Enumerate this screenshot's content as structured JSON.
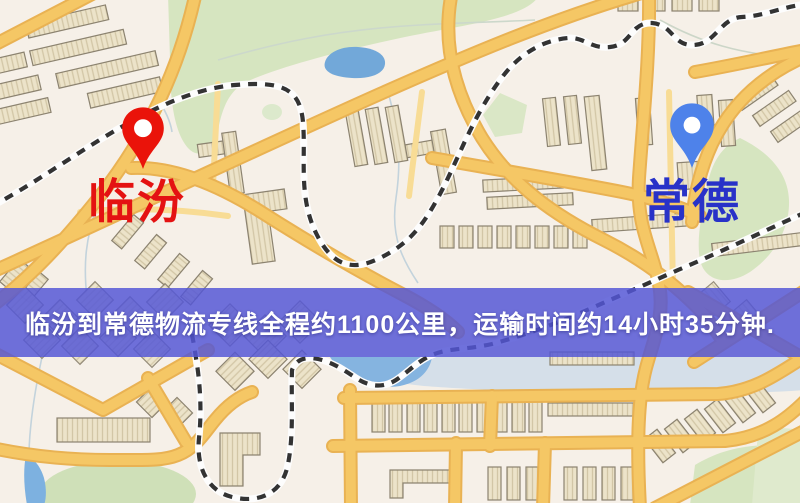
{
  "markers": {
    "origin": {
      "label": "临汾",
      "icon": "location-pin-icon",
      "pin_color": "#ea130a",
      "text_color": "#e41212"
    },
    "destination": {
      "label": "常德",
      "icon": "location-pin-icon",
      "pin_color": "#4e82ea",
      "text_color": "#2832c8"
    }
  },
  "banner": {
    "text": "临汾到常德物流专线全程约1100公里，运输时间约14小时35分钟.",
    "background_color": "#5456d5",
    "text_color": "#ffffff"
  },
  "route": {
    "origin": "临汾",
    "destination": "常德",
    "service": "物流专线",
    "distance": "约1100公里",
    "duration": "约14小时35分钟"
  },
  "map_palette": {
    "background": "#f6f0e8",
    "road_major": "#f5c765",
    "road_minor": "#f8dc95",
    "park_green": "#d6e5c0",
    "water_blue": "#72a8d9",
    "building_tan": "#ece3c9",
    "railway_dark": "#333333"
  }
}
